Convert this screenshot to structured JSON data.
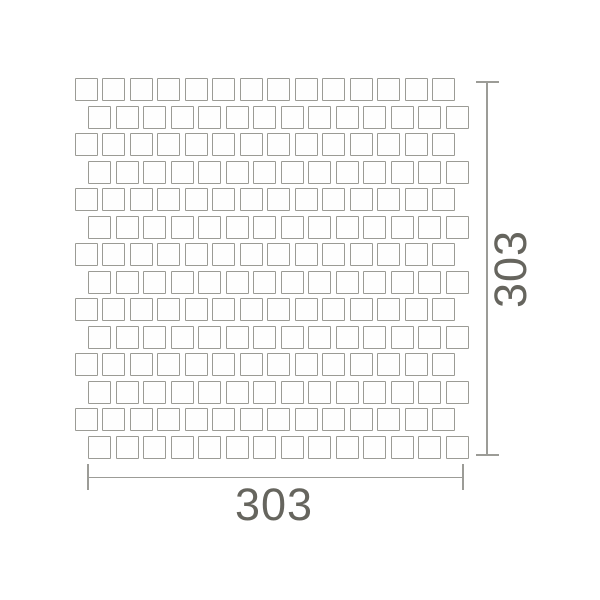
{
  "drawing": {
    "type": "mosaic-sheet-dimension-diagram",
    "width_dimension_label": "303",
    "height_dimension_label": "303"
  },
  "mosaic": {
    "rows": 14,
    "cols": 14,
    "tile_size_px": 23,
    "pitch_px": 27.5,
    "grid_left_px": 74.5,
    "grid_top_px": 78,
    "odd_row_offset_px": 13.75,
    "tile_fill": "#fefefe",
    "tile_border_color": "#9b9b95"
  },
  "colors": {
    "background": "#ffffff",
    "dimension_line": "#9c9c97",
    "label_text": "#66655e"
  }
}
